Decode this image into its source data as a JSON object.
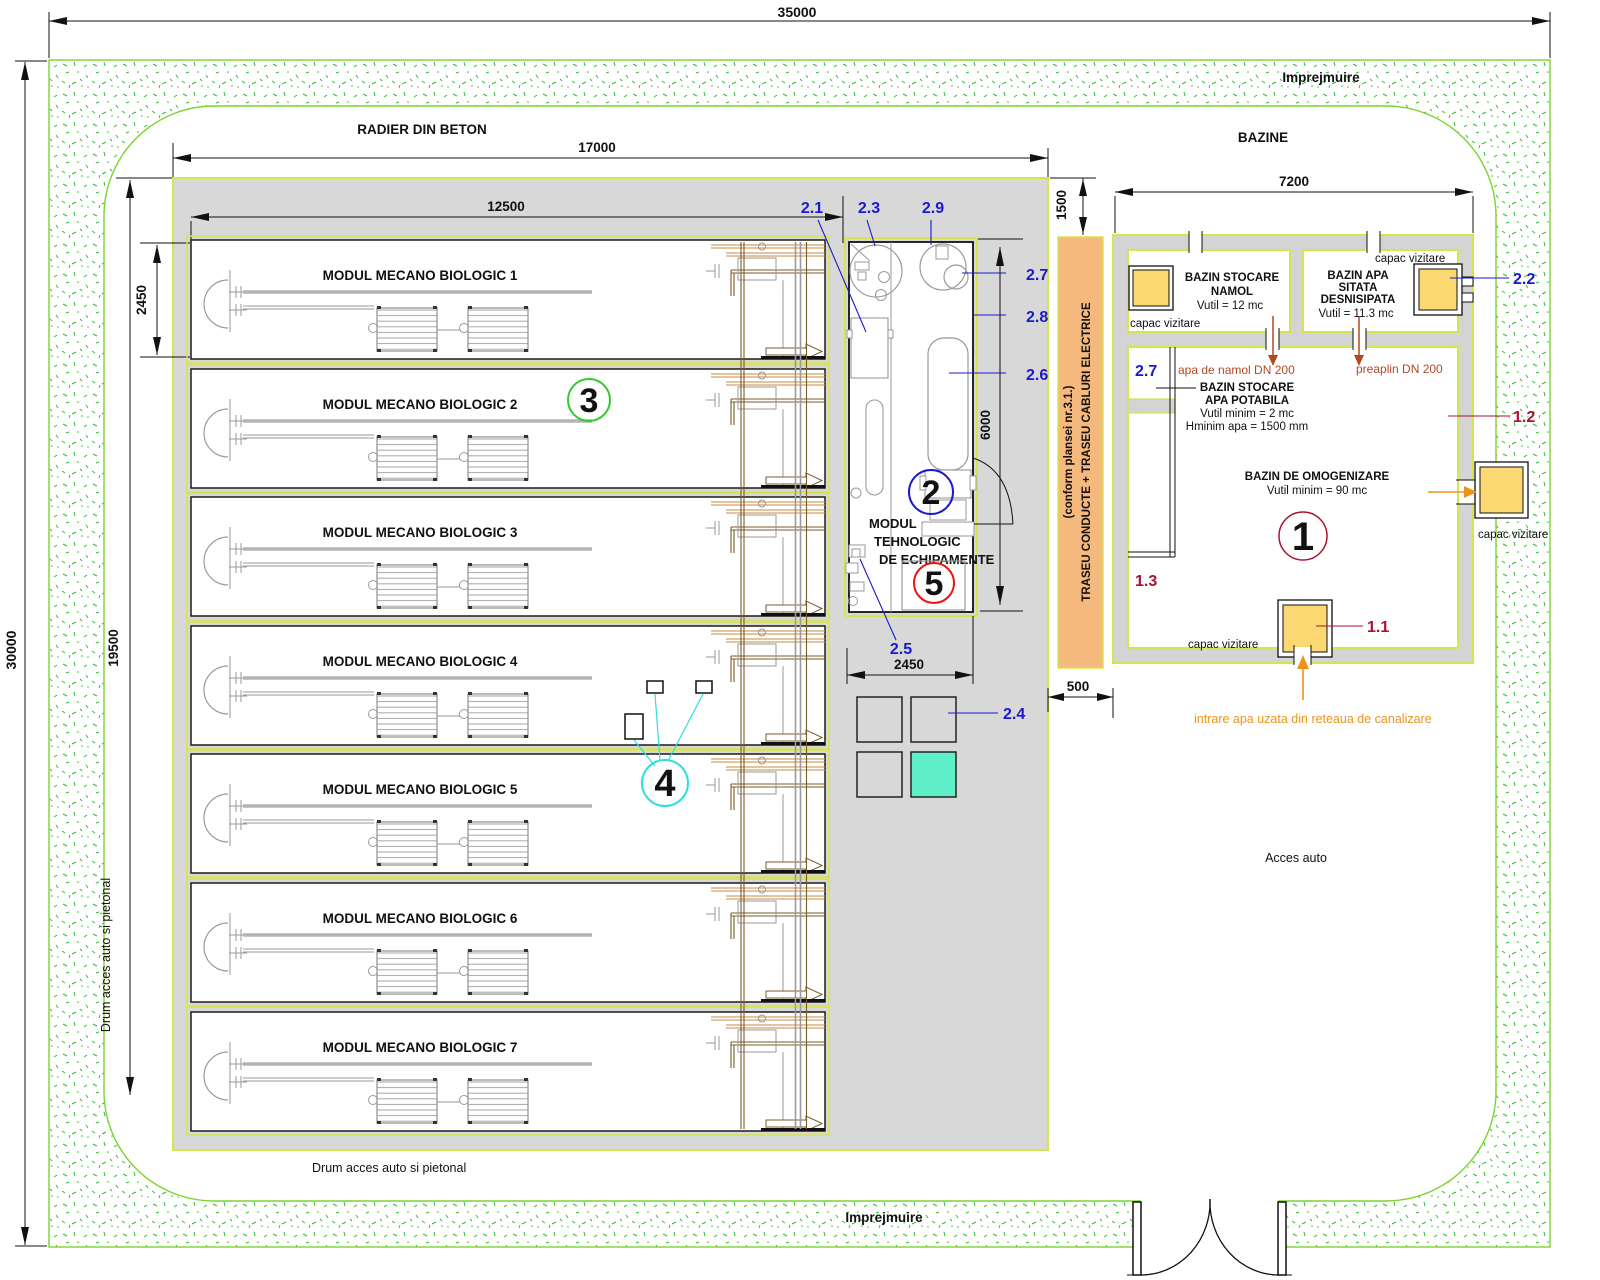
{
  "dims": {
    "top": "35000",
    "left": "30000",
    "radier_w": "17000",
    "modules_w": "12500",
    "modules_h": "19500",
    "module1_h": "2450",
    "tech_h": "6000",
    "tech_w": "2450",
    "gap": "500",
    "offset": "1500",
    "bazine_w": "7200"
  },
  "labels": {
    "radier": "RADIER DIN BETON",
    "bazine": "BAZINE",
    "imprejmuire_top": "Imprejmuire",
    "imprejmuire_bottom": "Imprejmuire",
    "drum_left": "Drum acces auto si pietonal",
    "drum_bottom": "Drum acces auto si pietonal",
    "acces_auto": "Acces auto"
  },
  "modules": {
    "items": [
      {
        "label": "MODUL MECANO BIOLOGIC 1"
      },
      {
        "label": "MODUL MECANO BIOLOGIC 2"
      },
      {
        "label": "MODUL MECANO BIOLOGIC 3"
      },
      {
        "label": "MODUL MECANO BIOLOGIC 4"
      },
      {
        "label": "MODUL MECANO BIOLOGIC 5"
      },
      {
        "label": "MODUL MECANO BIOLOGIC 6"
      },
      {
        "label": "MODUL MECANO BIOLOGIC 7"
      }
    ]
  },
  "tech": {
    "line1": "MODUL",
    "line2": "TEHNOLOGIC",
    "line3": "DE ECHIPAMENTE"
  },
  "callouts": {
    "c1": "1",
    "c11": "1.1",
    "c12": "1.2",
    "c13": "1.3",
    "c2": "2",
    "c21": "2.1",
    "c22": "2.2",
    "c23": "2.3",
    "c24": "2.4",
    "c25": "2.5",
    "c26": "2.6",
    "c27": "2.7",
    "c27b": "2.7",
    "c28": "2.8",
    "c29": "2.9",
    "c3": "3",
    "c4": "4",
    "c5": "5"
  },
  "traseu": {
    "line1": "TRASEU CONDUCTE + TRASEU CABLURI ELECTRICE",
    "line2": "(conform plansei nr.3.1.)"
  },
  "bazine": {
    "namol": {
      "t1": "BAZIN STOCARE",
      "t2": "NAMOL",
      "v": "Vutil = 12 mc",
      "capac": "capac vizitare"
    },
    "desnisipata": {
      "capac": "capac vizitare",
      "t1": "BAZIN APA",
      "t2": "SITATA",
      "t3": "DESNISIPATA",
      "v": "Vutil = 11.3 mc"
    },
    "potabila": {
      "t1": "BAZIN STOCARE",
      "t2": "APA POTABILA",
      "v1": "Vutil minim = 2 mc",
      "v2": "Hminim apa = 1500 mm",
      "pipe_namol": "apa de namol DN 200",
      "pipe_preaplin": "preaplin DN 200"
    },
    "omogenizare": {
      "t": "BAZIN DE OMOGENIZARE",
      "v": "Vutil minim = 90 mc",
      "capac_bottom": "capac vizitare",
      "capac_right": "capac vizitare",
      "intrare": "intrare apa uzata din reteaua de canalizare"
    }
  },
  "colors": {
    "fence_green": "#2ebf2e",
    "fence_outline": "#7cd42e",
    "border_yellow_green": "#d8e44c",
    "slab_gray": "#d8d8d8",
    "wall_gray": "#d4d4d4",
    "pipe_strip_orange": "#f5b87d",
    "capac_yellow": "#fcd873",
    "highlight_cyan": "#5ff0c9",
    "callout_blue": "#1a1acc",
    "callout_maroon": "#aa1133",
    "callout_red": "#ee1111",
    "callout_green": "#2ecc2e",
    "callout_cyan": "#2edede",
    "pipe_text_brown": "#b14a21",
    "flow_orange": "#ef9318"
  }
}
